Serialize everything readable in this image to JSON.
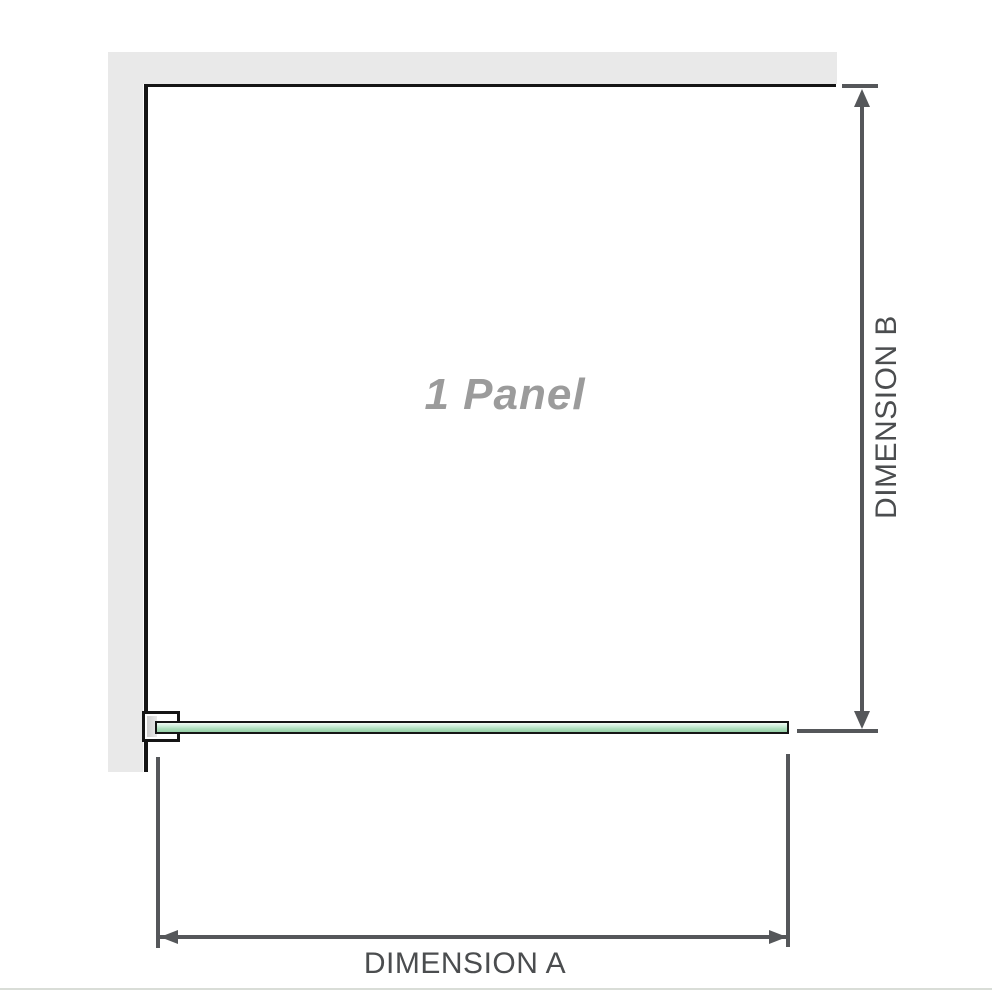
{
  "diagram": {
    "panel_label": "1 Panel",
    "dimension_a_label": "DIMENSION A",
    "dimension_b_label": "DIMENSION B",
    "panel_count": 1
  },
  "colors": {
    "wall_gray": "#e9e9e9",
    "structure_black": "#151515",
    "dim_gray": "#55575a",
    "text_gray": "#4b4d4f",
    "panel_label_gray": "#9b9b9b",
    "panel_green": "#a9dcba",
    "baseline_gray": "#d9ddd7"
  }
}
